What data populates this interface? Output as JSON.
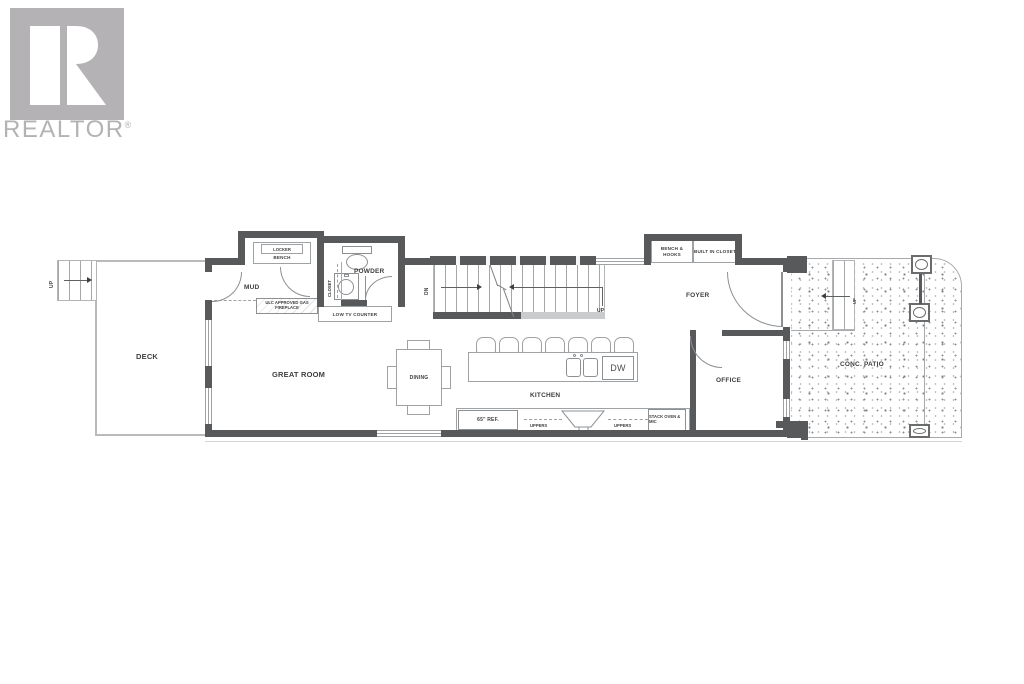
{
  "watermark": {
    "brand": "REALTOR",
    "registered": "®"
  },
  "colors": {
    "wall": "#58595b",
    "thin_line": "#a7a9ac",
    "label_text": "#3e3e40",
    "watermark_gray": "#b4b2b4"
  },
  "rooms": {
    "deck": "DECK",
    "mud": "MUD",
    "closet": "CLOSET",
    "powder": "POWDER",
    "great_room": "GREAT ROOM",
    "dining": "DINING",
    "kitchen": "KITCHEN",
    "foyer": "FOYER",
    "office": "OFFICE",
    "patio": "CONC. PATIO"
  },
  "mud_nook": {
    "locker": "LOCKER",
    "bench": "BENCH"
  },
  "foyer_nook": {
    "bench_hooks": "BENCH & HOOKS",
    "built_in_closet": "BUILT IN CLOSET"
  },
  "great_room_fixtures": {
    "fireplace": "ULC APPROVED GAS FIREPLACE",
    "tv_counter": "LOW TV COUNTER"
  },
  "kitchen_fixtures": {
    "fridge": "65\" REF.",
    "uppers_left": "UPPERS",
    "uppers_right": "UPPERS",
    "stack_oven": "STACK OVEN & MIC",
    "dishwasher": "DW"
  },
  "stairs": {
    "down": "DN",
    "up": "UP"
  },
  "deck_stairs": {
    "up": "UP"
  },
  "patio_steps": {
    "up": "UP"
  }
}
